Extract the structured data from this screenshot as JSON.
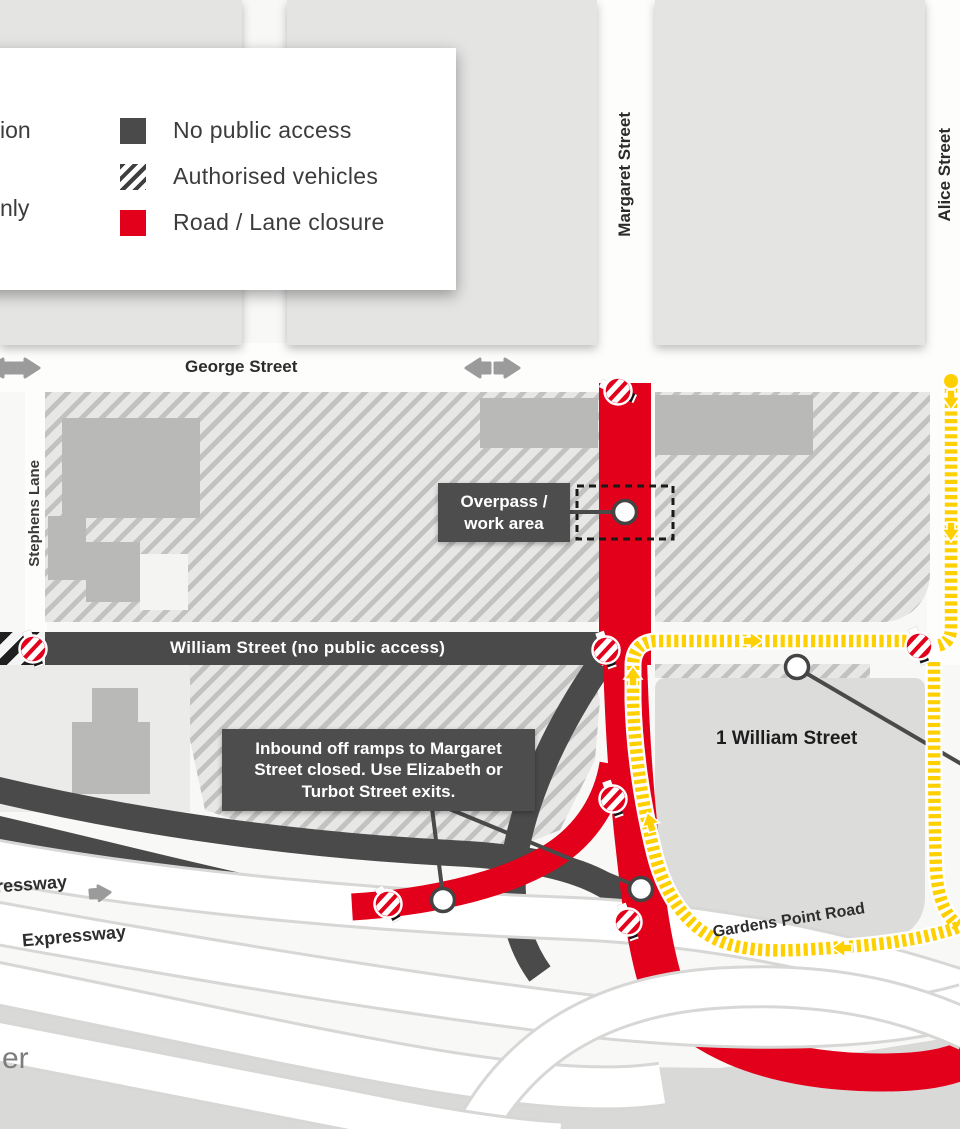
{
  "legend": {
    "cut_labels": [
      {
        "text": "ion"
      },
      {
        "text": "nly"
      }
    ],
    "items": [
      {
        "key": "no-public-access",
        "label": "No public access"
      },
      {
        "key": "authorised-vehicles",
        "label": "Authorised vehicles"
      },
      {
        "key": "road-lane-closure",
        "label": "Road / Lane closure"
      }
    ]
  },
  "labels": {
    "george_street": "George Street",
    "margaret_street": "Margaret Street",
    "alice_street": "Alice Street",
    "stephens_lane": "Stephens Lane",
    "william_street": "William Street (no public access)",
    "one_william_street": "1 William Street",
    "gardens_point_road": "Gardens Point Road",
    "expressway_partial_upper": "ressway",
    "expressway_partial_lower": "Expressway",
    "river_partial": "er"
  },
  "callouts": {
    "overpass": "Overpass /\nwork area",
    "inbound": "Inbound off ramps to Margaret Street closed. Use Elizabeth or Turbot Street exits."
  },
  "colors": {
    "closure_red": "#e2001a",
    "road_dark": "#4a4a4a",
    "diversion_yellow": "#ffd000"
  }
}
